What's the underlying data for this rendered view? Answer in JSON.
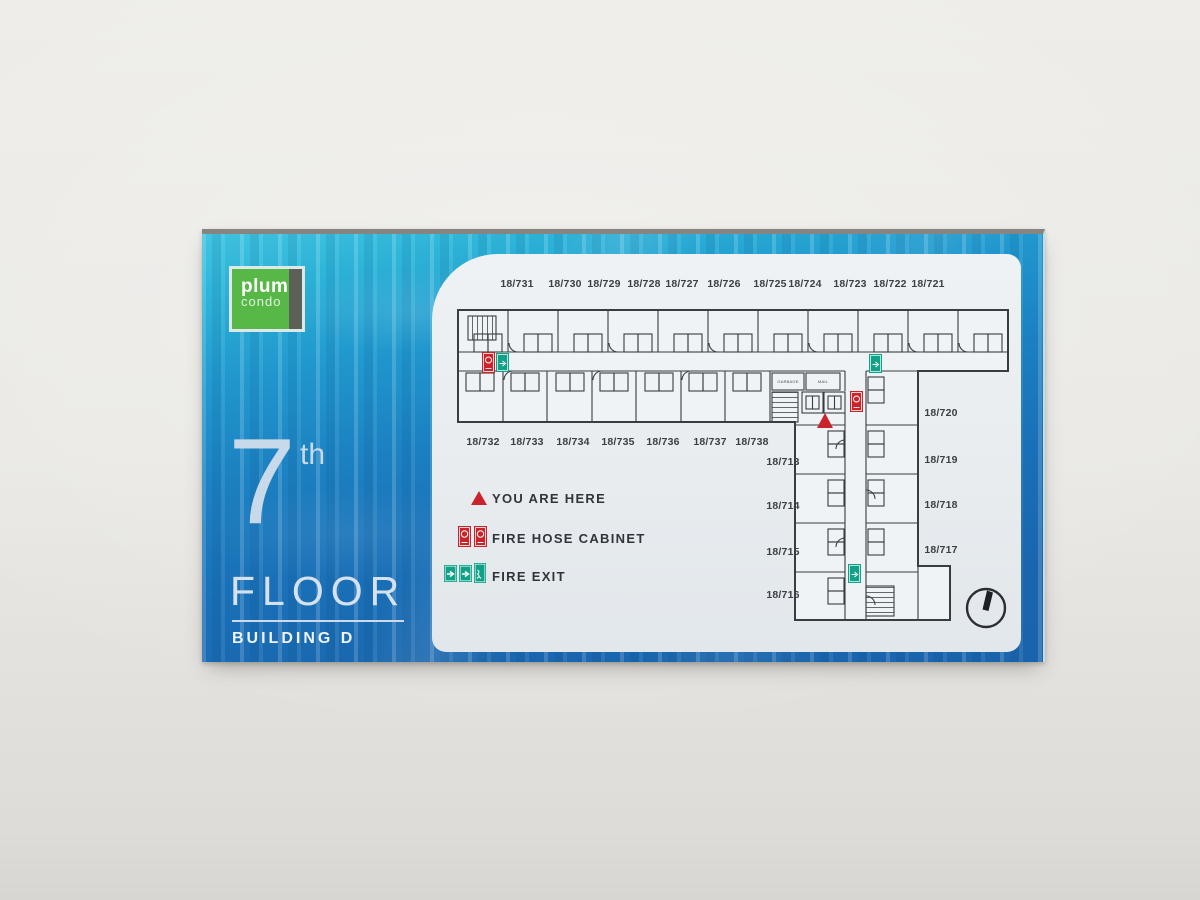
{
  "sign": {
    "logo": {
      "brand_top": "plum",
      "brand_bottom": "condo"
    },
    "floor": {
      "number": "7",
      "ordinal": "th",
      "label": "FLOOR",
      "building": "BUILDING D"
    }
  },
  "floorplan": {
    "units_top": [
      "18/731",
      "18/730",
      "18/729",
      "18/728",
      "18/727",
      "18/726",
      "18/725",
      "18/724",
      "18/723",
      "18/722",
      "18/721"
    ],
    "units_bottom": [
      "18/732",
      "18/733",
      "18/734",
      "18/735",
      "18/736",
      "18/737",
      "18/738"
    ],
    "units_wing_left": [
      "18/713",
      "18/714",
      "18/715",
      "18/716"
    ],
    "units_wing_right": [
      "18/720",
      "18/719",
      "18/718",
      "18/717"
    ],
    "rooms": {
      "garbage": "GARBAGE",
      "mail": "MAIL"
    },
    "legend": [
      {
        "icon": "you-are-here-icon",
        "label": "YOU ARE HERE"
      },
      {
        "icon": "fire-hose-cabinet-icon",
        "label": "FIRE HOSE CABINET"
      },
      {
        "icon": "fire-exit-icon",
        "label": "FIRE EXIT"
      }
    ]
  },
  "colors": {
    "panel_cyan": "#2fb9dc",
    "panel_blue": "#1a74ba",
    "logo_green": "#57b848",
    "map_bg": "#e9edf0",
    "plan_line": "#383d42",
    "alert_red": "#c9242c",
    "exit_green": "#12a188",
    "label_text": "#3b4045",
    "headline_text": "#d6e1ee"
  }
}
